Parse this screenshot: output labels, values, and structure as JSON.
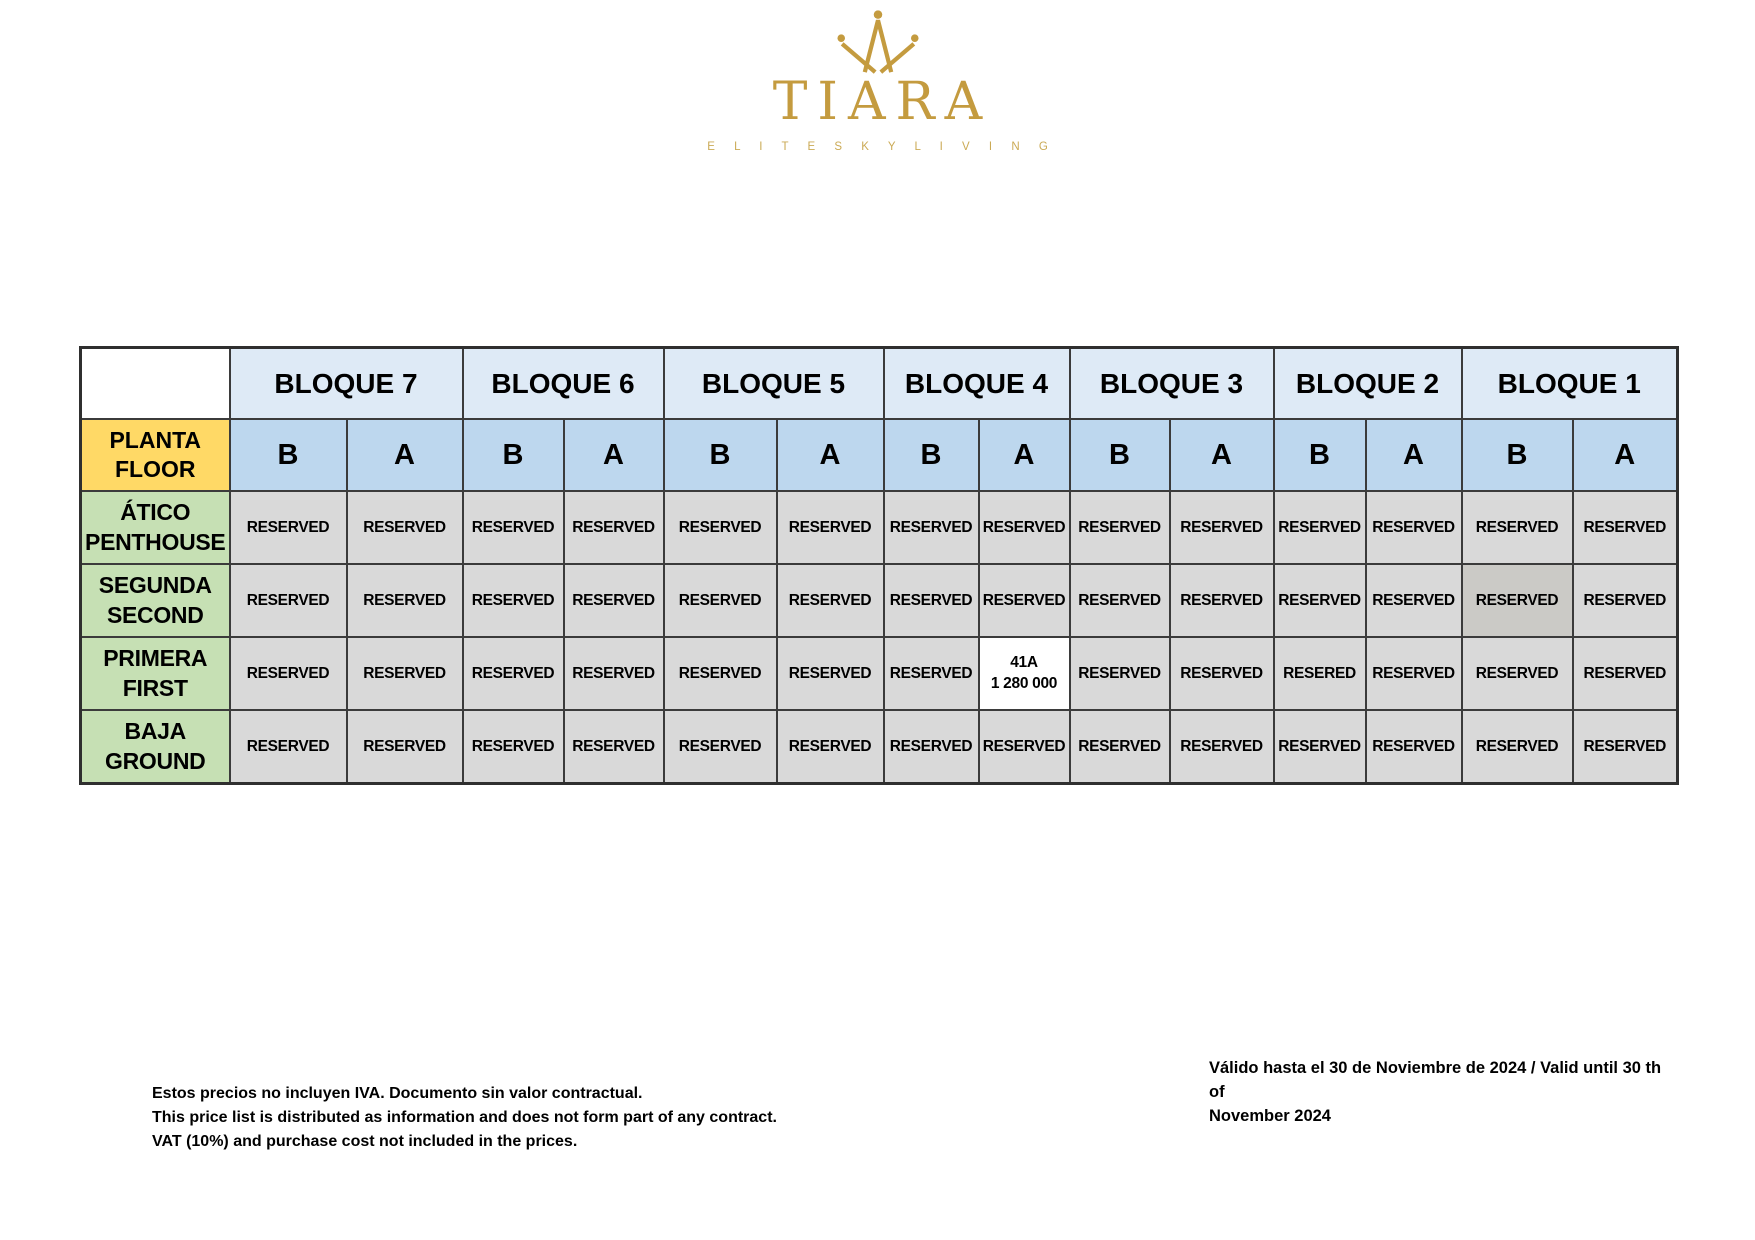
{
  "logo": {
    "brand": "TIARA",
    "tagline": "E L I T E   S K Y   L I V I N G",
    "gold": "#C49B3F",
    "gold_light": "#CBAA55"
  },
  "colors": {
    "bloque_header_blue": "#DEEAF6",
    "subheader_blue": "#BDD7EE",
    "corner_yellow": "#FFD966",
    "floor_green": "#C6E0B4",
    "reserved_gray": "#D9D9D9",
    "reserved_dark_gray": "#CBCAC6",
    "available_white": "#FFFFFF",
    "border_dark": "#3B3B3B"
  },
  "table": {
    "corner_lines": [
      "PLANTA",
      "FLOOR"
    ],
    "subcolumns": [
      "B",
      "A"
    ],
    "bloques": [
      {
        "label": "BLOQUE 7"
      },
      {
        "label": "BLOQUE 6"
      },
      {
        "label": "BLOQUE 5"
      },
      {
        "label": "BLOQUE 4"
      },
      {
        "label": "BLOQUE 3"
      },
      {
        "label": "BLOQUE 2"
      },
      {
        "label": "BLOQUE 1"
      }
    ],
    "floors": [
      {
        "lines": [
          "ÁTICO",
          "PENTHOUSE"
        ]
      },
      {
        "lines": [
          "SEGUNDA",
          "SECOND"
        ]
      },
      {
        "lines": [
          "PRIMERA",
          "FIRST"
        ]
      },
      {
        "lines": [
          "BAJA",
          "GROUND"
        ]
      }
    ],
    "rows": [
      {
        "cells": [
          {
            "text": "RESERVED"
          },
          {
            "text": "RESERVED"
          },
          {
            "text": "RESERVED"
          },
          {
            "text": "RESERVED"
          },
          {
            "text": "RESERVED"
          },
          {
            "text": "RESERVED"
          },
          {
            "text": "RESERVED"
          },
          {
            "text": "RESERVED"
          },
          {
            "text": "RESERVED"
          },
          {
            "text": "RESERVED"
          },
          {
            "text": "RESERVED"
          },
          {
            "text": "RESERVED"
          },
          {
            "text": "RESERVED"
          },
          {
            "text": "RESERVED"
          }
        ]
      },
      {
        "cells": [
          {
            "text": "RESERVED"
          },
          {
            "text": "RESERVED"
          },
          {
            "text": "RESERVED"
          },
          {
            "text": "RESERVED"
          },
          {
            "text": "RESERVED"
          },
          {
            "text": "RESERVED"
          },
          {
            "text": "RESERVED"
          },
          {
            "text": "RESERVED"
          },
          {
            "text": "RESERVED"
          },
          {
            "text": "RESERVED"
          },
          {
            "text": "RESERVED"
          },
          {
            "text": "RESERVED"
          },
          {
            "text": "RESERVED",
            "variant": "dark"
          },
          {
            "text": "RESERVED"
          }
        ]
      },
      {
        "cells": [
          {
            "text": "RESERVED"
          },
          {
            "text": "RESERVED"
          },
          {
            "text": "RESERVED"
          },
          {
            "text": "RESERVED"
          },
          {
            "text": "RESERVED"
          },
          {
            "text": "RESERVED"
          },
          {
            "text": "RESERVED"
          },
          {
            "lines": [
              "41A",
              "1 280 000"
            ],
            "variant": "available"
          },
          {
            "text": "RESERVED"
          },
          {
            "text": "RESERVED"
          },
          {
            "text": "RESERED"
          },
          {
            "text": "RESERVED"
          },
          {
            "text": "RESERVED"
          },
          {
            "text": "RESERVED"
          }
        ]
      },
      {
        "cells": [
          {
            "text": "RESERVED"
          },
          {
            "text": "RESERVED"
          },
          {
            "text": "RESERVED"
          },
          {
            "text": "RESERVED"
          },
          {
            "text": "RESERVED"
          },
          {
            "text": "RESERVED"
          },
          {
            "text": "RESERVED"
          },
          {
            "text": "RESERVED"
          },
          {
            "text": "RESERVED"
          },
          {
            "text": "RESERVED"
          },
          {
            "text": "RESERVED"
          },
          {
            "text": "RESERVED"
          },
          {
            "text": "RESERVED"
          },
          {
            "text": "RESERVED"
          }
        ]
      }
    ]
  },
  "footer": {
    "left_lines": [
      "Estos precios no incluyen IVA. Documento sin valor contractual.",
      "This price list is distributed as information and does not form part of any contract.",
      "VAT (10%) and purchase cost not included in the prices."
    ],
    "right_lines": [
      "Válido hasta el 30 de Noviembre de 2024 / Valid until 30 th of",
      "November 2024"
    ]
  }
}
